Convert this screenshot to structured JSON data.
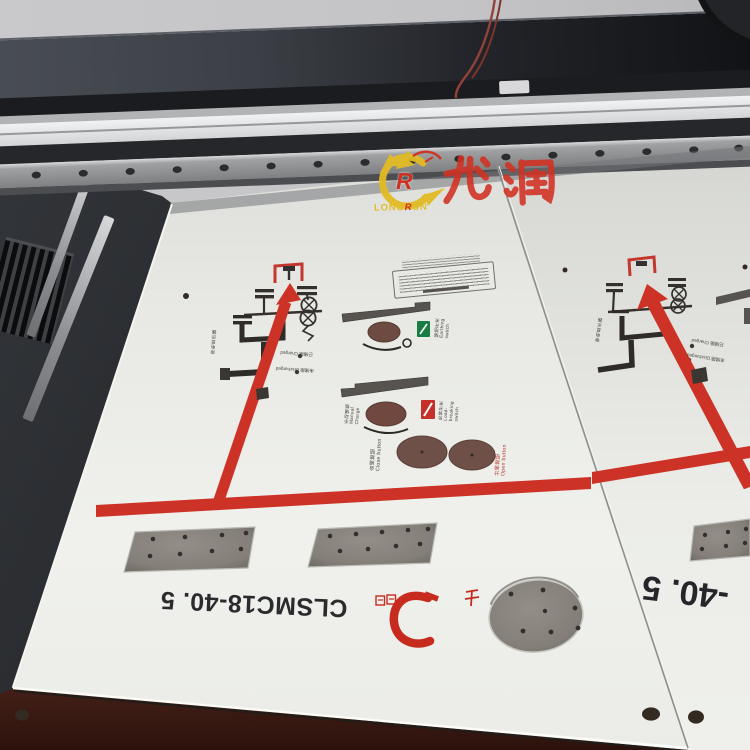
{
  "watermark": {
    "brand_cn": "龙润",
    "logo_letter": "R",
    "brand_en_p1": "LONG",
    "brand_en_p2": "R",
    "brand_en_p3": "UN"
  },
  "panels": {
    "left": {
      "model_text": "CLSMC18-40. 5",
      "registered_mark": "®",
      "labels": {
        "live_display": "带电显示器",
        "charged": "已储能 Charged",
        "discharged": "未储能 Discharged",
        "manual_charge": "手动储能 Manual Charge",
        "earth_switch": "接地开关 Earthing switch",
        "load_switch": "负荷开关 Load-breaking switch",
        "close_button": "合闸按钮 Close button",
        "open_button": "分闸按钮 Open button"
      }
    },
    "right": {
      "model_text_partial": "-40. 5",
      "labels": {
        "live_display": "带电显示器",
        "charged": "已储能 Charged",
        "discharged": "未储能 Discharged"
      }
    }
  },
  "colors": {
    "print_red": "#cd3227",
    "logo_yellow": "#e2bc25",
    "logo_red": "#ce3122",
    "panel_white": "#eceded",
    "bed_gray": "#8a857e",
    "table_maroon": "#4a241a"
  }
}
